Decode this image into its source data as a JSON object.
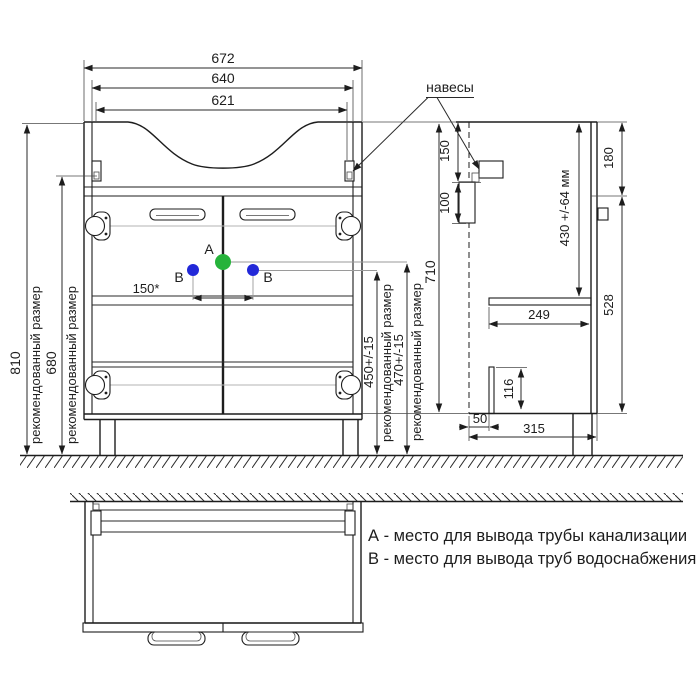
{
  "drawing": {
    "callout_hangers": "навесы",
    "labels": {
      "recommended": "рекомендованный размер",
      "point_a": "A",
      "point_b": "B"
    },
    "front_dims": {
      "width_overall": "672",
      "width_body": "640",
      "width_cutout": "621",
      "height_overall": "810",
      "height_hangers": "680",
      "height_cabinet": "710",
      "height_drain": "470+/-15",
      "height_water": "450+/-15",
      "water_spacing": "150*"
    },
    "side_dims": {
      "hanger_offset": "150",
      "rail_height": "100",
      "drain_depth": "430 +/-64 мм",
      "top_section": "180",
      "door_height": "528",
      "shelf_depth": "249",
      "back_panel": "116",
      "back_offset": "50",
      "depth_total": "315"
    },
    "legend": {
      "line_a": "А - место для вывода трубы канализации",
      "line_b": "В - место для вывода труб водоснабжения"
    },
    "colors": {
      "marker_a": "#26b33b",
      "marker_b": "#2228d8"
    }
  }
}
